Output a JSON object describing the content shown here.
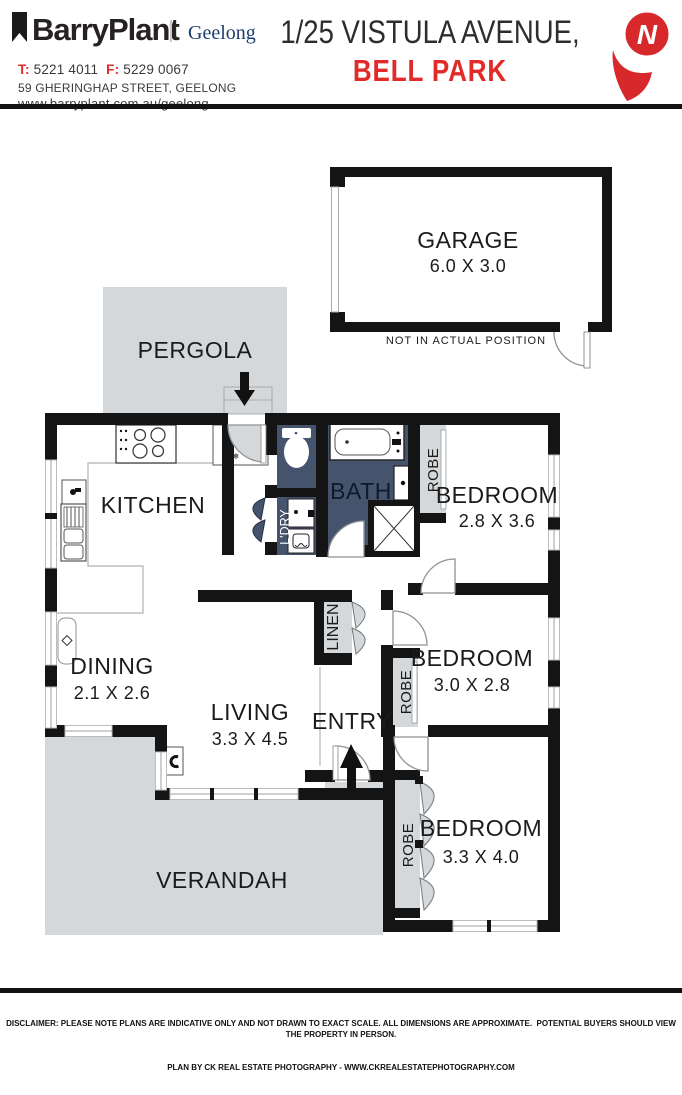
{
  "header": {
    "brand": "BarryPlant",
    "office": "Geelong",
    "phone": {
      "t_label": "T:",
      "t_value": " 5221 4011  ",
      "f_label": "F:",
      "f_value": " 5229 0067"
    },
    "address": "59 GHERINGHAP STREET, GEELONG",
    "website": "www.barryplant.com.au/geelong",
    "title_line1": "1/25 VISTULA AVENUE,",
    "title_line2": "BELL PARK",
    "north": "N"
  },
  "plan": {
    "garage": {
      "name": "GARAGE",
      "dims": "6.0 X 3.0",
      "note": "NOT IN ACTUAL POSITION"
    },
    "pergola": "PERGOLA",
    "kitchen": "KITCHEN",
    "dining": {
      "name": "DINING",
      "dims": "2.1 X 2.6"
    },
    "living": {
      "name": "LIVING",
      "dims": "3.3 X 4.5"
    },
    "entry": "ENTRY",
    "bath": "BATH",
    "laundry": "L'DRY",
    "linen": "LINEN",
    "robe": "ROBE",
    "verandah": "VERANDAH",
    "bedrooms": [
      {
        "name": "BEDROOM",
        "dims": "2.8 X 3.6"
      },
      {
        "name": "BEDROOM",
        "dims": "3.0 X 2.8"
      },
      {
        "name": "BEDROOM",
        "dims": "3.3 X 4.0"
      }
    ]
  },
  "icons": {
    "snowflake": "❄"
  },
  "footer": {
    "disclaimer": "DISCLAIMER: PLEASE NOTE PLANS ARE INDICATIVE ONLY AND NOT DRAWN TO EXACT SCALE. ALL DIMENSIONS ARE APPROXIMATE.  POTENTIAL BUYERS SHOULD VIEW THE PROPERTY IN PERSON.",
    "credit": "PLAN BY CK REAL ESTATE PHOTOGRAPHY - WWW.CKREALESTATEPHOTOGRAPHY.COM"
  },
  "colors": {
    "accent_red": "#e22a28",
    "navy": "#46536d",
    "light_gray": "#d5d8da",
    "wall_black": "#141414",
    "office_blue": "#1d3d71"
  }
}
